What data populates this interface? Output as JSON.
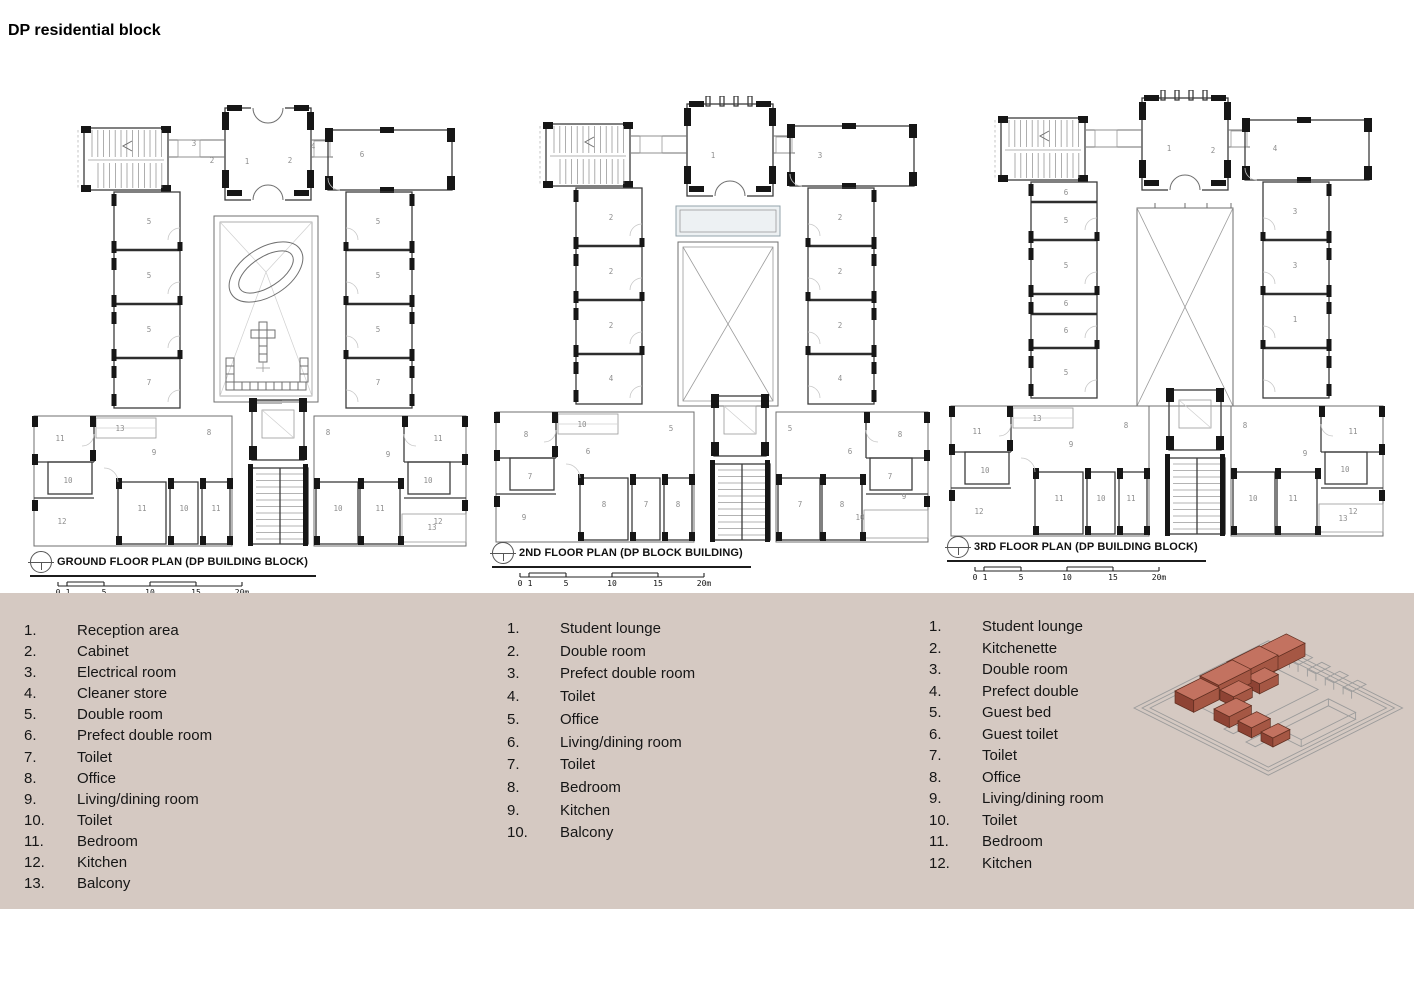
{
  "page": {
    "title": "DP residential block",
    "colors": {
      "panel_background": "#d5c9c2",
      "highlight_building": "#b2604c",
      "site_outline": "#9b9b9b"
    }
  },
  "scale_labels": [
    "0",
    "1",
    "5",
    "10",
    "15",
    "20m"
  ],
  "plans": [
    {
      "name": "ground-floor",
      "title": "GROUND FLOOR PLAN (DP BUILDING BLOCK)",
      "courtyard": "oval",
      "labels": [
        [
          "3",
          166,
          46
        ],
        [
          "2",
          184,
          63
        ],
        [
          "1",
          219,
          64
        ],
        [
          "2",
          262,
          63
        ],
        [
          "4",
          285,
          49
        ],
        [
          "6",
          334,
          57
        ],
        [
          "5",
          121,
          124
        ],
        [
          "5",
          121,
          178
        ],
        [
          "5",
          121,
          232
        ],
        [
          "7",
          121,
          285
        ],
        [
          "5",
          350,
          124
        ],
        [
          "5",
          350,
          178
        ],
        [
          "5",
          350,
          232
        ],
        [
          "7",
          350,
          285
        ],
        [
          "11",
          32,
          341
        ],
        [
          "13",
          92,
          331
        ],
        [
          "8",
          181,
          335
        ],
        [
          "9",
          126,
          355
        ],
        [
          "10",
          40,
          383
        ],
        [
          "12",
          34,
          424
        ],
        [
          "11",
          114,
          411
        ],
        [
          "10",
          156,
          411
        ],
        [
          "11",
          188,
          411
        ],
        [
          "8",
          300,
          335
        ],
        [
          "9",
          360,
          357
        ],
        [
          "11",
          410,
          341
        ],
        [
          "10",
          400,
          383
        ],
        [
          "12",
          410,
          424
        ],
        [
          "10",
          310,
          411
        ],
        [
          "11",
          352,
          411
        ],
        [
          "13",
          404,
          430
        ]
      ]
    },
    {
      "name": "second-floor",
      "title": "2ND FLOOR PLAN (DP BLOCK BUILDING)",
      "courtyard": "cross-bridge",
      "labels": [
        [
          "1",
          223,
          62
        ],
        [
          "3",
          330,
          62
        ],
        [
          "2",
          121,
          124
        ],
        [
          "2",
          121,
          178
        ],
        [
          "2",
          121,
          232
        ],
        [
          "4",
          121,
          285
        ],
        [
          "2",
          350,
          124
        ],
        [
          "2",
          350,
          178
        ],
        [
          "2",
          350,
          232
        ],
        [
          "4",
          350,
          285
        ],
        [
          "8",
          36,
          341
        ],
        [
          "10",
          92,
          331
        ],
        [
          "5",
          181,
          335
        ],
        [
          "6",
          98,
          358
        ],
        [
          "7",
          40,
          383
        ],
        [
          "9",
          34,
          424
        ],
        [
          "8",
          114,
          411
        ],
        [
          "7",
          156,
          411
        ],
        [
          "8",
          188,
          411
        ],
        [
          "5",
          300,
          335
        ],
        [
          "6",
          360,
          358
        ],
        [
          "8",
          410,
          341
        ],
        [
          "7",
          400,
          383
        ],
        [
          "7",
          310,
          411
        ],
        [
          "8",
          352,
          411
        ],
        [
          "10",
          370,
          424
        ],
        [
          "9",
          414,
          403
        ]
      ]
    },
    {
      "name": "third-floor",
      "title": "3RD FLOOR PLAN (DP BUILDING BLOCK)",
      "courtyard": "cross",
      "labels": [
        [
          "1",
          224,
          61
        ],
        [
          "2",
          268,
          63
        ],
        [
          "4",
          330,
          61
        ],
        [
          "6",
          121,
          105
        ],
        [
          "5",
          121,
          133
        ],
        [
          "5",
          121,
          178
        ],
        [
          "6",
          121,
          216
        ],
        [
          "6",
          121,
          243
        ],
        [
          "5",
          121,
          285
        ],
        [
          "3",
          350,
          124
        ],
        [
          "3",
          350,
          178
        ],
        [
          "1",
          350,
          232
        ],
        [
          "11",
          32,
          344
        ],
        [
          "13",
          92,
          331
        ],
        [
          "8",
          181,
          338
        ],
        [
          "9",
          126,
          357
        ],
        [
          "10",
          40,
          383
        ],
        [
          "12",
          34,
          424
        ],
        [
          "11",
          114,
          411
        ],
        [
          "10",
          156,
          411
        ],
        [
          "11",
          186,
          411
        ],
        [
          "8",
          300,
          338
        ],
        [
          "9",
          360,
          366
        ],
        [
          "11",
          408,
          344
        ],
        [
          "10",
          400,
          382
        ],
        [
          "12",
          408,
          424
        ],
        [
          "10",
          308,
          411
        ],
        [
          "11",
          348,
          411
        ],
        [
          "13",
          398,
          431
        ]
      ]
    }
  ],
  "legends": [
    {
      "items": [
        [
          "1.",
          "Reception area"
        ],
        [
          "2.",
          "Cabinet"
        ],
        [
          "3.",
          "Electrical room"
        ],
        [
          "4.",
          "Cleaner store"
        ],
        [
          "5.",
          "Double room"
        ],
        [
          "6.",
          "Prefect double room"
        ],
        [
          "7.",
          "Toilet"
        ],
        [
          "8.",
          "Office"
        ],
        [
          "9.",
          "Living/dining room"
        ],
        [
          "10.",
          "Toilet"
        ],
        [
          "11.",
          "Bedroom"
        ],
        [
          "12.",
          "Kitchen"
        ],
        [
          "13.",
          "Balcony"
        ]
      ]
    },
    {
      "items": [
        [
          "1.",
          "Student lounge"
        ],
        [
          "2.",
          "Double room"
        ],
        [
          "3.",
          "Prefect double room"
        ],
        [
          "4.",
          "Toilet"
        ],
        [
          "5.",
          "Office"
        ],
        [
          "6.",
          "Living/dining room"
        ],
        [
          "7.",
          "Toilet"
        ],
        [
          "8.",
          "Bedroom"
        ],
        [
          "9.",
          "Kitchen"
        ],
        [
          "10.",
          "Balcony"
        ]
      ]
    },
    {
      "items": [
        [
          "1.",
          "Student lounge"
        ],
        [
          "2.",
          "Kitchenette"
        ],
        [
          "3.",
          "Double room"
        ],
        [
          "4.",
          "Prefect double"
        ],
        [
          "5.",
          "Guest bed"
        ],
        [
          "6.",
          "Guest toilet"
        ],
        [
          "7.",
          "Toilet"
        ],
        [
          "8.",
          "Office"
        ],
        [
          "9.",
          "Living/dining room"
        ],
        [
          "10.",
          "Toilet"
        ],
        [
          "11.",
          "Bedroom"
        ],
        [
          "12.",
          "Kitchen"
        ]
      ]
    }
  ],
  "isometric": {
    "description": "site isometric with DP residential block highlighted",
    "highlight_color": "#b2604c"
  }
}
